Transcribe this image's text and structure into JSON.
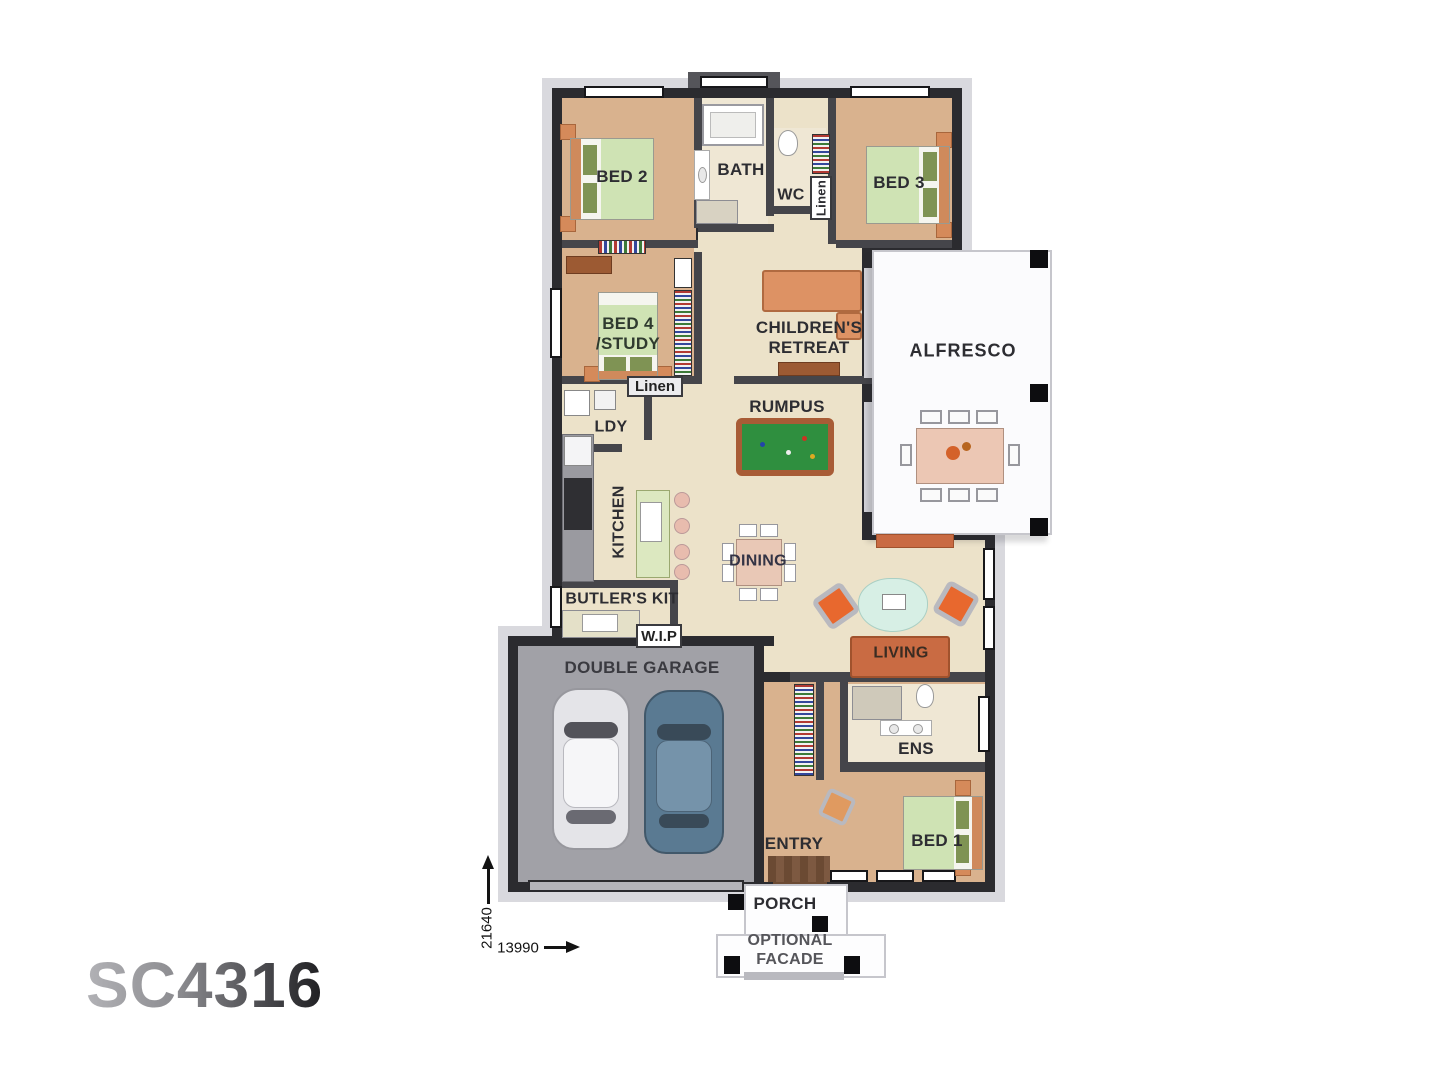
{
  "plan": {
    "code": "SC4316",
    "rooms": {
      "bed2": "BED 2",
      "bath": "BATH",
      "wc": "WC",
      "linen_wc": "Linen",
      "bed3": "BED 3",
      "bed4": "BED 4\n/STUDY",
      "retreat": "CHILDREN'S\nRETREAT",
      "alfresco": "ALFRESCO",
      "linen_mid": "Linen",
      "rumpus": "RUMPUS",
      "ldy": "LDY",
      "kitchen": "KITCHEN",
      "dining": "DINING",
      "butlers": "BUTLER'S KIT",
      "wip": "W.I.P",
      "garage": "DOUBLE GARAGE",
      "living": "LIVING",
      "ens": "ENS",
      "entry": "ENTRY",
      "bed1": "BED 1",
      "porch": "PORCH",
      "optional_facade": "OPTIONAL\nFACADE"
    },
    "dimensions": {
      "depth": "21640",
      "width": "13990"
    },
    "colors": {
      "wall_dark": "#2b2b2f",
      "wall_mid": "#45454a",
      "eave_gray": "#d9d9de",
      "floor_cream": "#ece2c9",
      "floor_tan": "#d9b28e",
      "floor_pale": "#efe7d4",
      "garage_gray": "#a1a1a7",
      "bed_green": "#cfe3b4",
      "pillow_green": "#7f9354",
      "accent_orange": "#d47347",
      "pool_green": "#2f8f3f",
      "rug_mint": "#d7efe5",
      "table_pink": "#ecc7b4",
      "label_ink": "#2d2d32"
    }
  }
}
